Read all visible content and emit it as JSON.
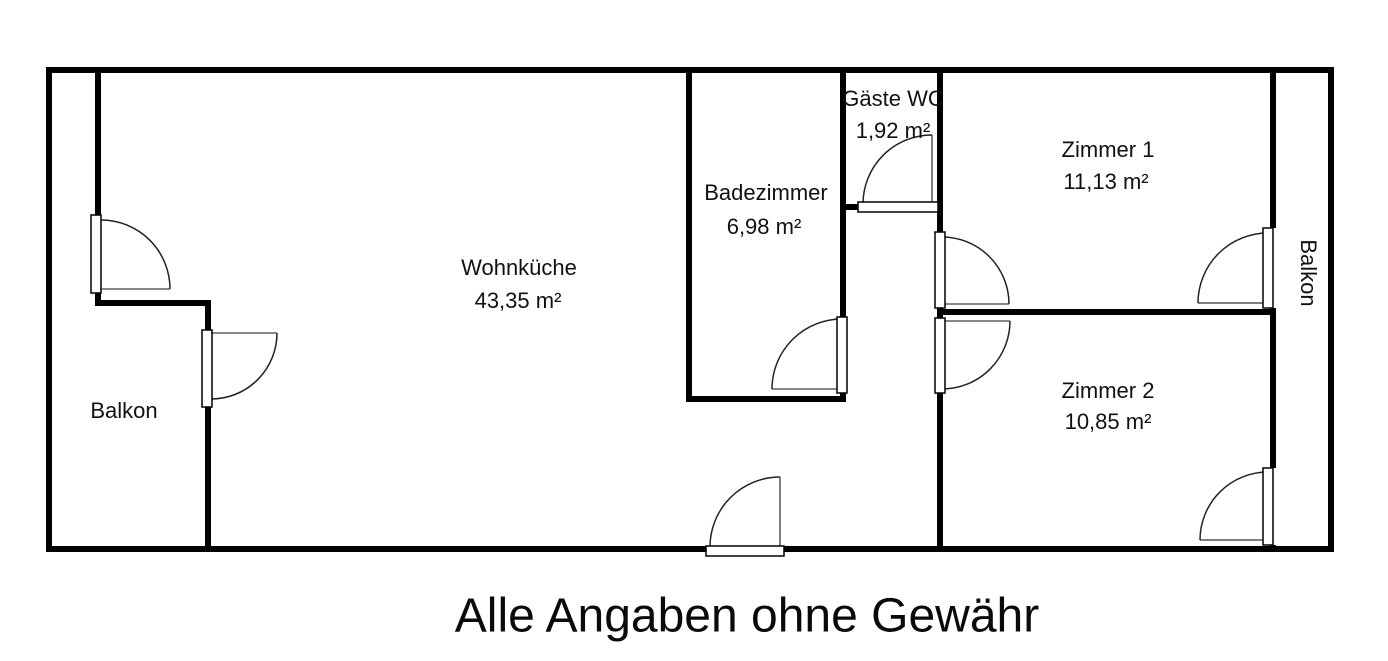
{
  "title": "Grundriss",
  "rooms": {
    "wohnkueche": {
      "label": "Wohnküche",
      "area": "43,35 m²"
    },
    "badezimmer": {
      "label": "Badezimmer",
      "area": "6,98 m²"
    },
    "gaeste_wc": {
      "label": "Gäste WC",
      "area": "1,92 m²"
    },
    "zimmer1": {
      "label": "Zimmer 1",
      "area": "11,13 m²"
    },
    "zimmer2": {
      "label": "Zimmer 2",
      "area": "10,85 m²"
    },
    "balkon_left": {
      "label": "Balkon"
    },
    "balkon_right": {
      "label": "Balkon"
    }
  },
  "footer": {
    "disclaimer": "Alle Angaben ohne Gewähr"
  },
  "colors": {
    "background": "#ffffff",
    "wall": "#000000",
    "door_leaf_fill": "#ffffff",
    "door_swing_arc": "#222222",
    "door_closed_line": "#888888"
  }
}
